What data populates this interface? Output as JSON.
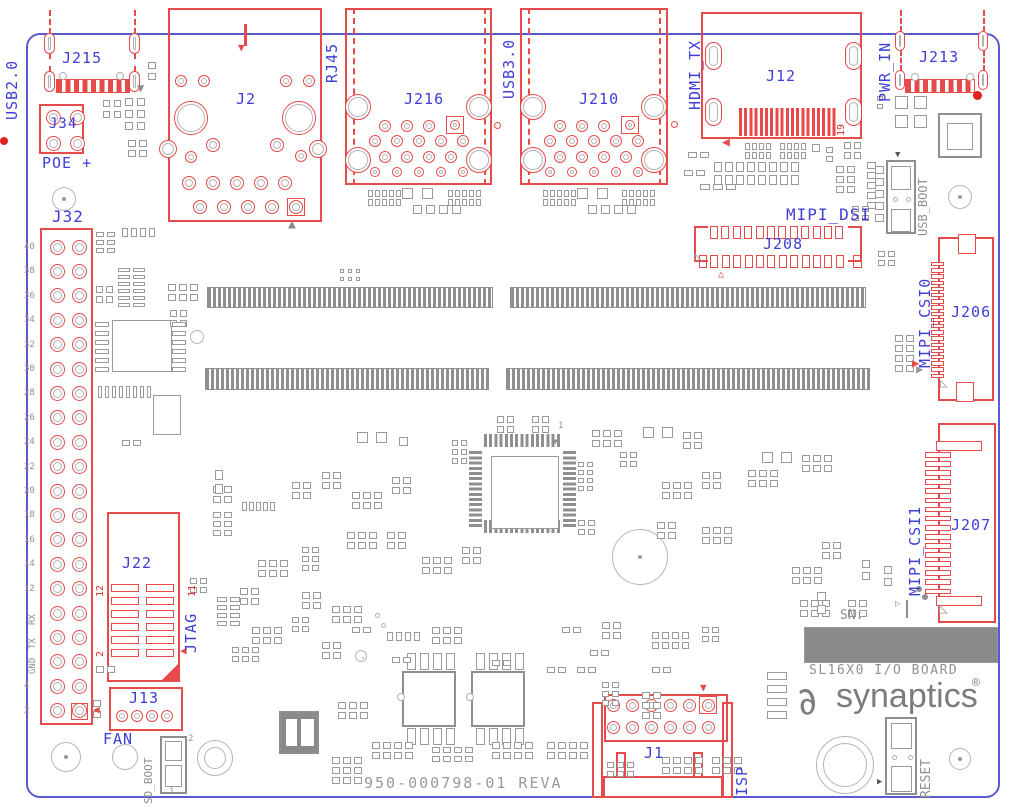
{
  "board": {
    "part_number": "950-000798-01 REVA",
    "title": "SL16X0 I/O BOARD",
    "brand": "synaptics",
    "reg": "®",
    "sn_label": "SN:"
  },
  "ports": {
    "usb2": "USB2.0",
    "poe": "POE +",
    "rj45": "RJ45",
    "usb3": "USB3.0",
    "hdmi": "HDMI_TX",
    "pwr": "PWR_IN",
    "mipi_dsi": "MIPI_DSI",
    "mipi_csi0": "MIPI_CSI0",
    "mipi_csi1": "MIPI_CSI1",
    "jtag": "JTAG",
    "fan": "FAN",
    "isp": "ISP"
  },
  "refs": {
    "j215": "J215",
    "j34": "J34",
    "j2": "J2",
    "j216": "J216",
    "j210": "J210",
    "j12": "J12",
    "j213": "J213",
    "j32": "J32",
    "j22": "J22",
    "j13": "J13",
    "j208": "J208",
    "j206": "J206",
    "j207": "J207",
    "j1": "J1"
  },
  "switches": {
    "usb_boot": "USB_BOOT",
    "sd_boot": "SD_BOOT",
    "reset": "RESET",
    "sd_pin_top": "2",
    "sd_pin_bottom": "1"
  },
  "pins": {
    "j32": [
      "40",
      "38",
      "36",
      "34",
      "32",
      "30",
      "28",
      "26",
      "24",
      "22",
      "20",
      "18",
      "16",
      "14",
      "12",
      "RX",
      "TX",
      "GND",
      "4",
      "2"
    ],
    "j22_top": "12",
    "j22_bottom": "2",
    "j22_right": "11",
    "j12_right": "19",
    "qfp_pin1": "1"
  },
  "colors": {
    "silk_red": "#e64a4a",
    "silk_gray": "#8f8f8f",
    "label_blue": "#3d3dd8",
    "outline_blue": "#5a5ad0"
  }
}
